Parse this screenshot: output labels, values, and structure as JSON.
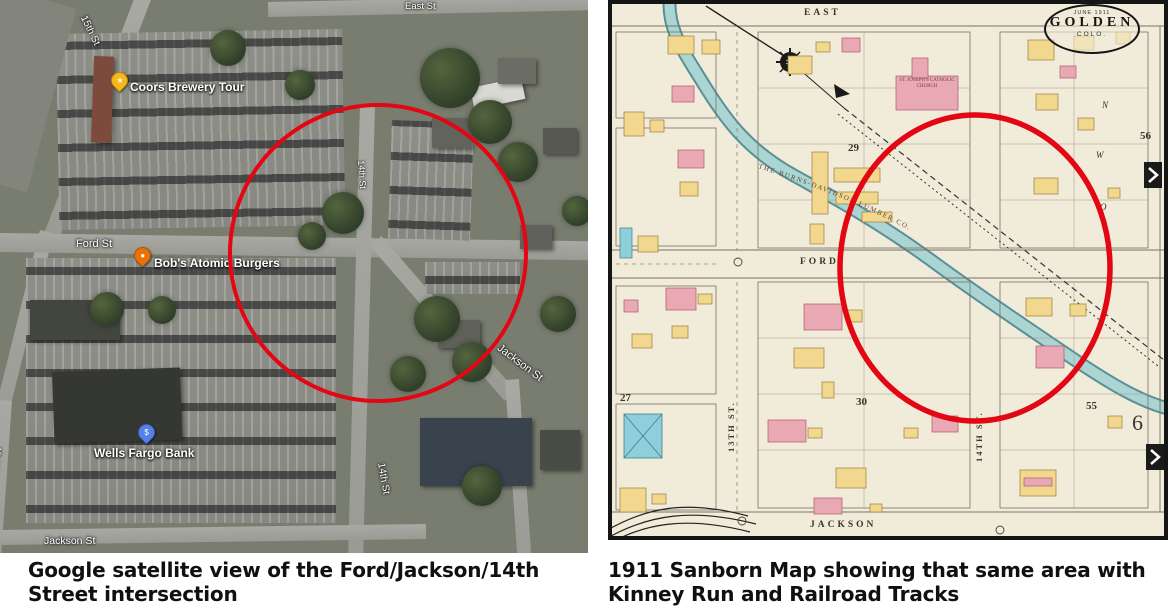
{
  "captions": {
    "left": "Google satellite view of the Ford/Jackson/14th Street intersection",
    "right": "1911 Sanborn Map showing that same area with Kinney Run and Railroad Tracks"
  },
  "satellite": {
    "pois": [
      {
        "label": "Coors Brewery Tour",
        "glyph": "★",
        "pin_color": "#f5b816"
      },
      {
        "label": "Bob's Atomic Burgers",
        "glyph": "●",
        "pin_color": "#e8710a"
      },
      {
        "label": "Wells Fargo Bank",
        "glyph": "$",
        "pin_color": "#5680e9"
      }
    ],
    "streets": {
      "east": "East St",
      "fifteenth_top": "15th St",
      "fifteenth_left": "15th St",
      "ford": "Ford St",
      "fourteenth_mid": "14th St",
      "fourteenth_bottom": "14th St",
      "jackson_diag": "Jackson St",
      "jackson_bottom": "Jackson St"
    }
  },
  "sanborn": {
    "title_oval": {
      "date": "JUNE 1911",
      "city": "GOLDEN",
      "state": "COLO."
    },
    "streets": {
      "east": "EAST",
      "ford": "FORD",
      "jackson": "JACKSON",
      "thirteenth": "13TH ST.",
      "fourteenth": "14TH ST."
    },
    "blocks": {
      "b29": "29",
      "b56": "56",
      "b27": "27",
      "b30": "30",
      "b55": "55",
      "b6": "6"
    },
    "labels": {
      "church": "ST. JOSEPH'S CATHOLIC CHURCH",
      "lumber": "THE BURNS-DAVIDSON LUMBER CO."
    },
    "letters": [
      "N",
      "W",
      "O"
    ]
  },
  "colors": {
    "circle_red": "#e30613",
    "paper": "#f1ebd9",
    "water": "#a9d6d6",
    "building_yellow": "#f2d78e",
    "building_pink": "#e8a8b4",
    "building_blue": "#8ecfdb"
  }
}
